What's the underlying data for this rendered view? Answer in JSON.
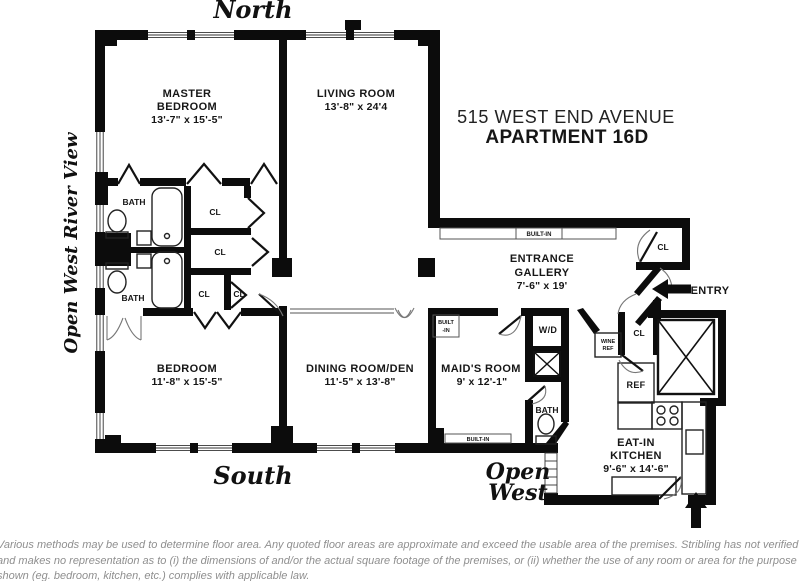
{
  "header": {
    "address": "515 WEST END AVENUE",
    "apartment": "APARTMENT 16D"
  },
  "compass": {
    "north": "North",
    "south": "South",
    "open_west": [
      "Open",
      "West"
    ],
    "river_view": "Open West River View"
  },
  "rooms": {
    "master_bedroom": {
      "lines": [
        "MASTER",
        "BEDROOM"
      ],
      "dims": "13'-7\" x 15'-5\""
    },
    "living_room": {
      "name": "LIVING ROOM",
      "dims": "13'-8\" x 24'4"
    },
    "entrance_gallery": {
      "lines": [
        "ENTRANCE",
        "GALLERY"
      ],
      "dims": "7'-6\" x 19'"
    },
    "bedroom": {
      "name": "BEDROOM",
      "dims": "11'-8\" x 15'-5\""
    },
    "dining_room": {
      "name": "DINING ROOM/DEN",
      "dims": "11'-5\" x 13'-8\""
    },
    "maids_room": {
      "name": "MAID'S ROOM",
      "dims": "9' x 12'-1\""
    },
    "kitchen": {
      "lines": [
        "EAT-IN",
        "KITCHEN"
      ],
      "dims": "9'-6\" x 14'-6\""
    }
  },
  "labels": {
    "bath_upper": "BATH",
    "bath_lower": "BATH",
    "bath_maids": "BATH",
    "closet_top": "CL",
    "closet_mid": "CL",
    "closet_bottom_left": "CL",
    "closet_bottom_right": "CL",
    "closet_gallery": "CL",
    "closet_kitchen": "CL",
    "washer_dryer": "W/D",
    "wine_ref": [
      "WINE",
      "REF"
    ],
    "ref": "REF",
    "built_in_gallery": "BUILT-IN",
    "built_in_maids_wall": [
      "BUILT",
      "-IN"
    ],
    "built_in_maids_south": "BUILT-IN",
    "entry": "ENTRY"
  },
  "disclaimer": {
    "line1": "Various methods may be used to determine floor area. Any quoted floor areas are approximate and exceed the usable area of the premises. Stribling has not verified it",
    "line2": "and makes no representation as to (i) the dimensions of and/or the actual square footage of the premises, or (ii) whether the use of any room or area for the purpose",
    "line3": "shown (eg. bedroom, kitchen, etc.) complies with applicable law."
  },
  "colors": {
    "wall": "#0c0c0c",
    "label_ink": "#161616",
    "disclaimer_ink": "#8f8f8f",
    "background": "#ffffff"
  }
}
